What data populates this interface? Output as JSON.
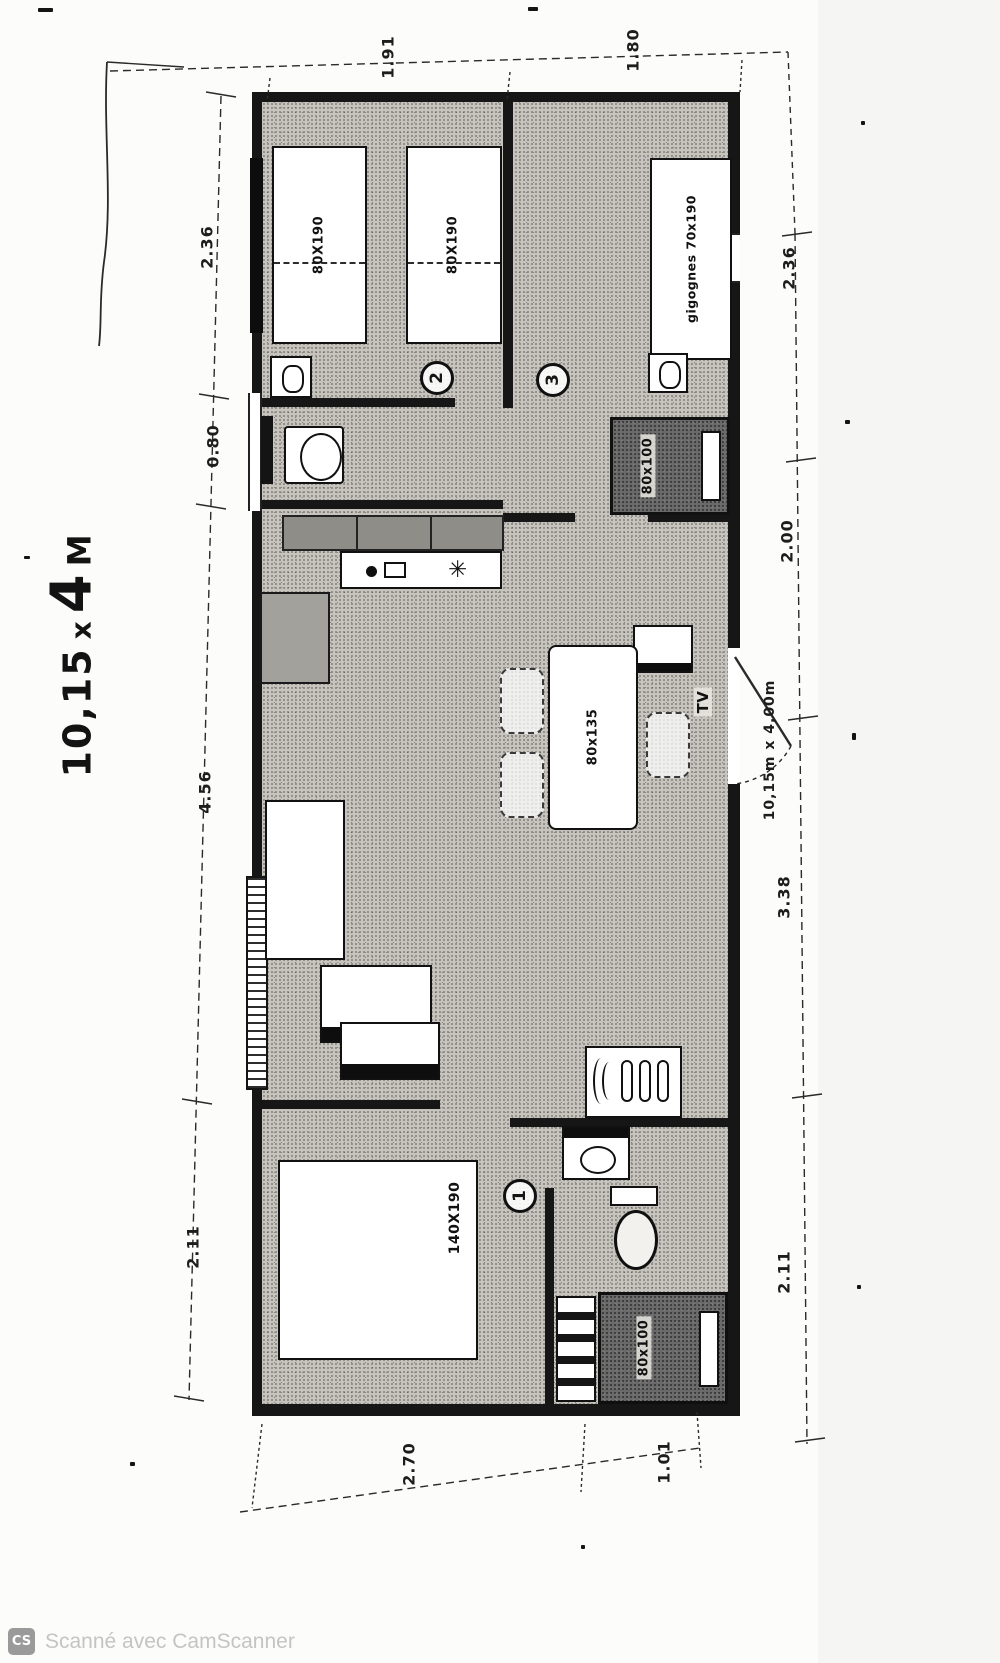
{
  "title": {
    "prefix": "10,15",
    "times": "x",
    "big": "4",
    "unit": "M"
  },
  "dimensions": {
    "top": [
      "1.91",
      "1.80"
    ],
    "left": [
      "2.36",
      "0.80",
      "4.56",
      "2.11"
    ],
    "right": [
      "2.36",
      "2.00",
      "3.38",
      "2.11"
    ],
    "bottom": [
      "2.70",
      "1.01"
    ],
    "overall": "10,15m x 4,00m"
  },
  "rooms": {
    "bedroom2": {
      "number": "2",
      "bed_a": "80X190",
      "bed_b": "80X190"
    },
    "bedroom3": {
      "number": "3",
      "bed": "gigognes 70x190",
      "wardrobe": "80x100"
    },
    "bedroom1": {
      "number": "1",
      "bed": "140X190"
    },
    "living": {
      "table": "80x135",
      "tv": "TV"
    },
    "kitchen": {
      "hob_icon": "✳"
    },
    "bathroom": {
      "shower": "80x100"
    }
  },
  "watermark": {
    "badge": "CS",
    "text": "Scanné avec CamScanner"
  },
  "colors": {
    "wall": "#161616",
    "dim_line": "#2a2a2a",
    "floor": "#c7c4be",
    "dark_fill": "#6a6a6a",
    "watermark_text": "#c4c4c4"
  }
}
